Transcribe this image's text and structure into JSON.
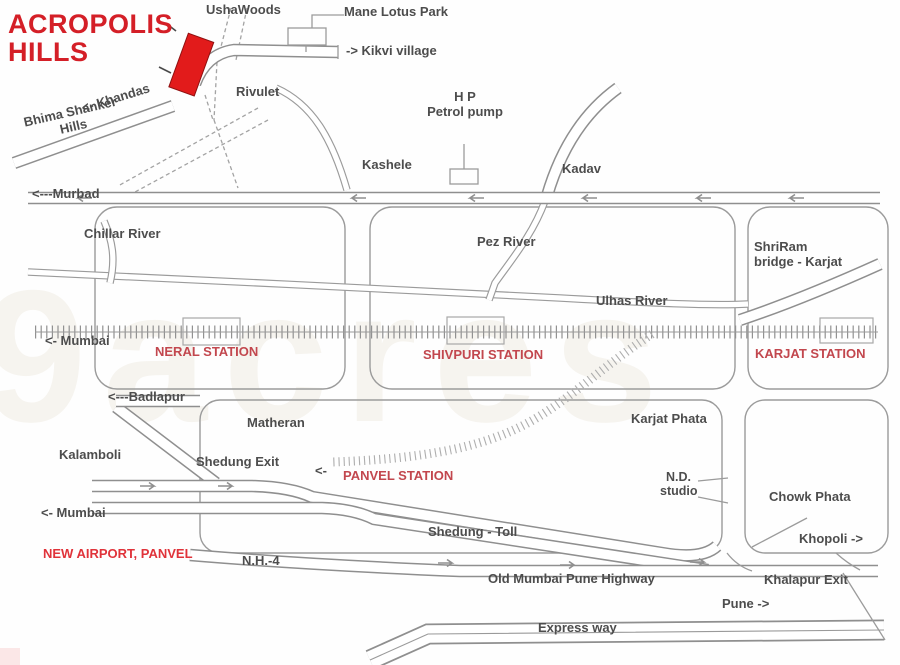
{
  "title": {
    "line1": "ACROPOLIS",
    "line2": "HILLS"
  },
  "colors": {
    "title_red": "#d41f27",
    "station_red": "#c2474e",
    "highlight_red": "#e0333a",
    "marker_red": "#e21b1b",
    "road_gray": "#8f8f8f"
  },
  "marker": {
    "name": "Acropolis Hills site marker"
  },
  "places": {
    "usha_woods": "UshaWoods",
    "mane_lotus_park": "Mane Lotus Park",
    "kikvi_village": "-> Kikvi village",
    "khandas": "<- Khandas",
    "rivulet": "Rivulet",
    "bhima_shanker_line1": "Bhima Shanker",
    "bhima_shanker_line2": "Hills",
    "murbad": "<---Murbad",
    "chillar_river": "Chillar River",
    "kashele": "Kashele",
    "hp_line1": "H P",
    "hp_line2": "Petrol pump",
    "kadav": "Kadav",
    "pez_river": "Pez River",
    "shriram_line1": "ShriRam",
    "shriram_line2": "bridge - Karjat",
    "ulhas_river": "Ulhas River",
    "mumbai_rail": "<- Mumbai",
    "badlapur": "<---Badlapur",
    "matheran": "Matheran",
    "karjat_phata": "Karjat Phata",
    "kalamboli": "Kalamboli",
    "shedung_exit": "Shedung Exit",
    "panvel_arrow": "<-",
    "nd_studio_line1": "N.D.",
    "nd_studio_line2": "studio",
    "chowk_phata": "Chowk Phata",
    "mumbai_road": "<- Mumbai",
    "shedung_toll": "Shedung - Toll",
    "khopoli": "Khopoli ->",
    "nh4": "N.H.-4",
    "old_highway": "Old Mumbai Pune Highway",
    "khalapur_exit": "Khalapur Exit",
    "pune": "Pune ->",
    "express_way": "Express way"
  },
  "stations": {
    "neral": "NERAL STATION",
    "shivpuri": "SHIVPURI STATION",
    "karjat": "KARJAT STATION",
    "panvel": "PANVEL STATION"
  },
  "highlights": {
    "new_airport": "NEW AIRPORT, PANVEL"
  },
  "watermark": "9acres"
}
